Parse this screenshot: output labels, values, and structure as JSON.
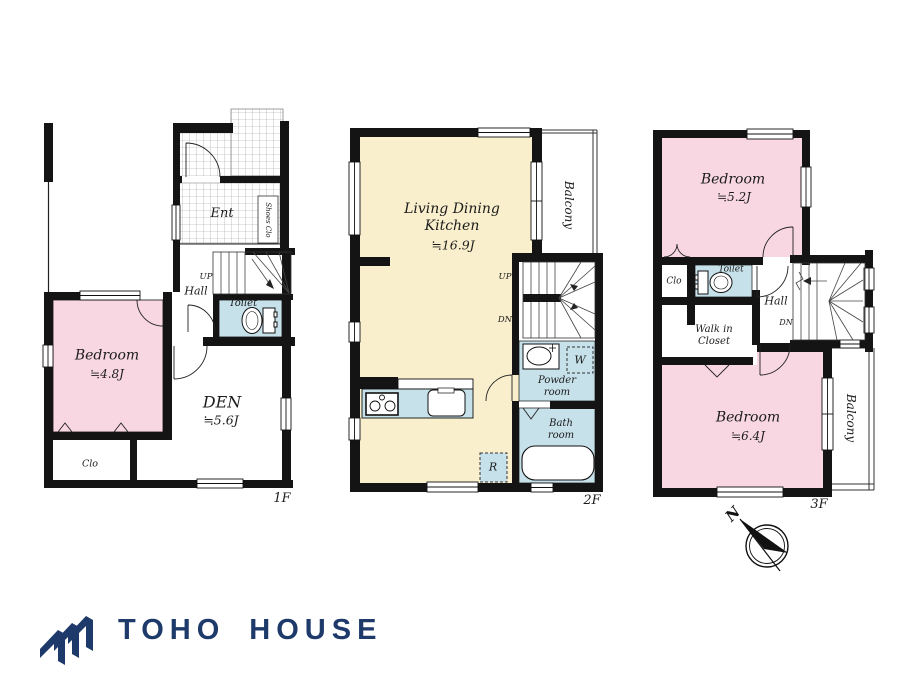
{
  "colors": {
    "wall": "#141414",
    "room_pink": "#f8d7e3",
    "room_cream": "#f9efcd",
    "room_blue": "#c6e1ea",
    "logo_navy": "#1d3a6a"
  },
  "floor1": {
    "floor_label": "1F",
    "ent": "Ent",
    "shoes_closet": "Shoes Clo",
    "up": "UP",
    "hall": "Hall",
    "toilet": "Toilet",
    "bedroom_name": "Bedroom",
    "bedroom_size": "≒4.8J",
    "den_name": "DEN",
    "den_size": "≒5.6J",
    "closet": "Clo"
  },
  "floor2": {
    "floor_label": "2F",
    "ldk_name": "Living Dining\nKitchen",
    "ldk_size": "≒16.9J",
    "balcony": "Balcony",
    "up": "UP",
    "down": "DN",
    "washer": "W",
    "powder_room": "Powder\nroom",
    "bath_room": "Bath\nroom",
    "refrigerator": "R"
  },
  "floor3": {
    "floor_label": "3F",
    "bedroom1_name": "Bedroom",
    "bedroom1_size": "≒5.2J",
    "closet": "Clo",
    "toilet": "Toilet",
    "hall": "Hall",
    "down": "DN",
    "walk_in_closet": "Walk in\nCloset",
    "bedroom2_name": "Bedroom",
    "bedroom2_size": "≒6.4J",
    "balcony": "Balcony"
  },
  "compass": {
    "north": "N"
  },
  "logo": {
    "name": "TOHO HOUSE"
  }
}
